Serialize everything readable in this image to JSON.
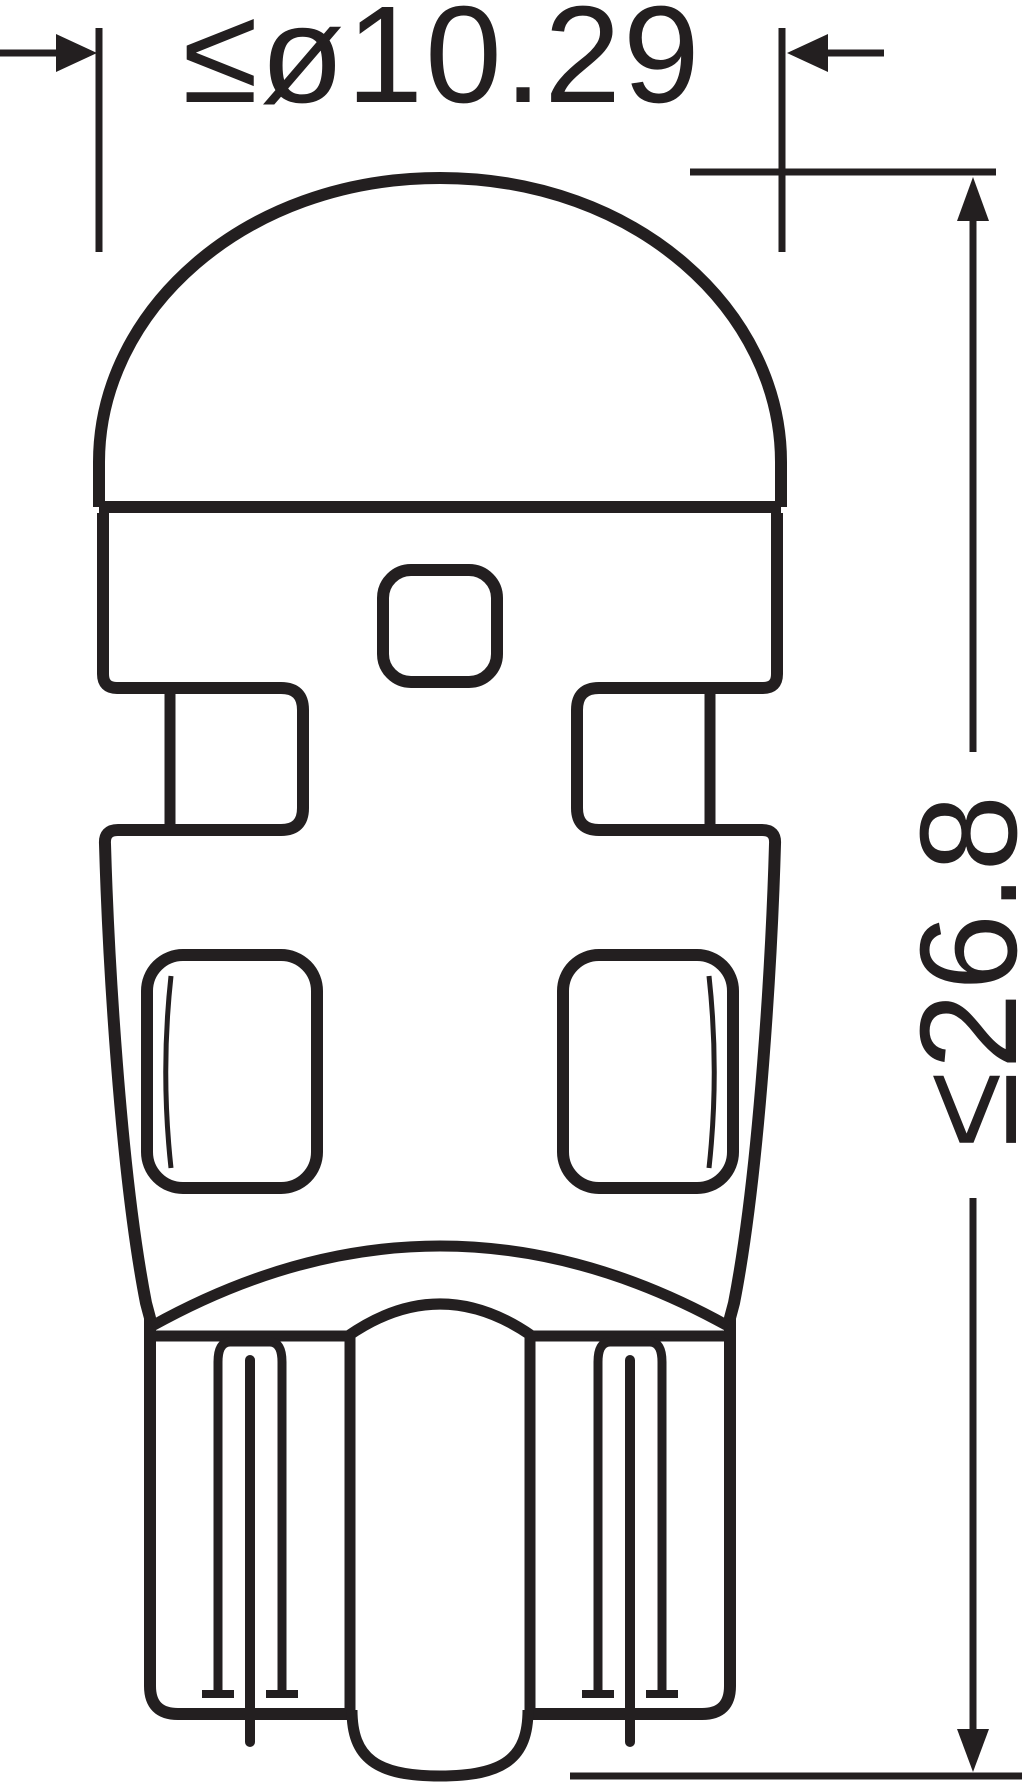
{
  "figure": {
    "type": "technical-dimension-drawing",
    "background_color": "#ffffff",
    "line_color": "#231f20"
  },
  "dimensions": {
    "diameter": {
      "label": "≤ø10.29"
    },
    "length": {
      "label": "≤26.8"
    }
  }
}
